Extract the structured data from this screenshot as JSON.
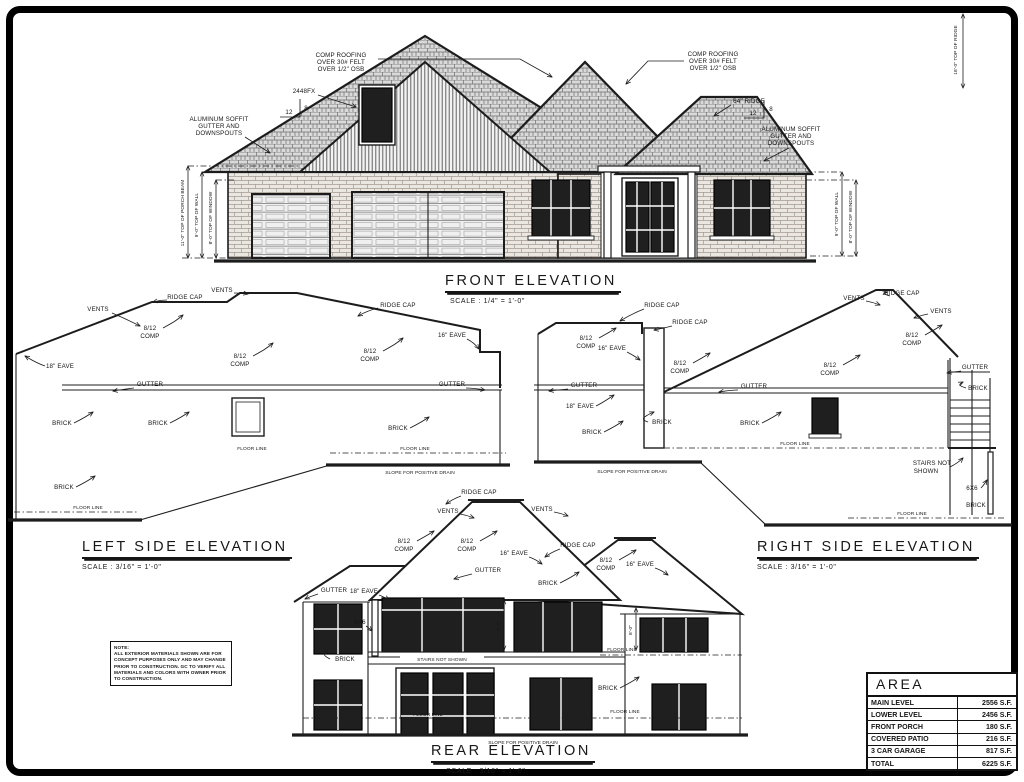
{
  "titles": {
    "front": {
      "label": "FRONT ELEVATION",
      "scale": "SCALE : 1/4\" = 1'-0\""
    },
    "left": {
      "label": "LEFT SIDE ELEVATION",
      "scale": "SCALE : 3/16\" = 1'-0\""
    },
    "right": {
      "label": "RIGHT SIDE ELEVATION",
      "scale": "SCALE : 3/16\" = 1'-0\""
    },
    "rear": {
      "label": "REAR ELEVATION",
      "scale": "SCALE : 3/16\" = 1'-0\""
    }
  },
  "labels": {
    "vents": "VENTS",
    "ridge_cap": "RIDGE CAP",
    "pitch": "8/12",
    "comp": "COMP",
    "eave16": "16\" EAVE",
    "eave18": "18\" EAVE",
    "gutter": "GUTTER",
    "brick": "BRICK",
    "floor_line": "FLOOR LINE",
    "slope_drain": "SLOPE FOR POSITIVE DRAIN",
    "stairs_l1": "STAIRS NOT",
    "stairs_l2": "SHOWN",
    "stairs_full": "STAIRS NOT SHOWN",
    "post": "6X6",
    "window_code": "2448FX",
    "ridge_label": "64\" RIDGE",
    "slope_rise": "12",
    "slope_run": "8",
    "comp_roofing": [
      "COMP ROOFING",
      "OVER 30# FELT",
      "OVER 1/2\" OSB"
    ],
    "alum": [
      "ALUMINUM SOFFIT",
      "GUTTER AND",
      "DOWNSPOUTS"
    ]
  },
  "dims": {
    "porch_beam": "11'-0\" TOP OF PORCH BEAM",
    "top_wall": "9'-0\" TOP OF WALL",
    "top_window": "8'-0\" TOP OF WINDOW",
    "top_ridge": "18'-0\" TOP OF RIDGE",
    "rear_9": "9'-0\"",
    "rear_8": "8'-0\""
  },
  "note": {
    "lines": [
      "NOTE:",
      "ALL EXTERIOR MATERIALS SHOWN ARE FOR",
      "CONCEPT PURPOSES ONLY AND MAY CHANGE",
      "PRIOR TO CONSTRUCTION. GC TO VERIFY ALL",
      "MATERIALS AND COLORS WITH OWNER PRIOR",
      "TO CONSTRUCTION."
    ]
  },
  "area_table": {
    "title": "AREA",
    "rows": [
      {
        "label": "MAIN LEVEL",
        "value": "2556 S.F."
      },
      {
        "label": "LOWER LEVEL",
        "value": "2456 S.F."
      },
      {
        "label": "FRONT PORCH",
        "value": "180 S.F."
      },
      {
        "label": "COVERED PATIO",
        "value": "216 S.F."
      },
      {
        "label": "3 CAR GARAGE",
        "value": "817 S.F."
      },
      {
        "label": "TOTAL",
        "value": "6225 S.F."
      }
    ]
  }
}
